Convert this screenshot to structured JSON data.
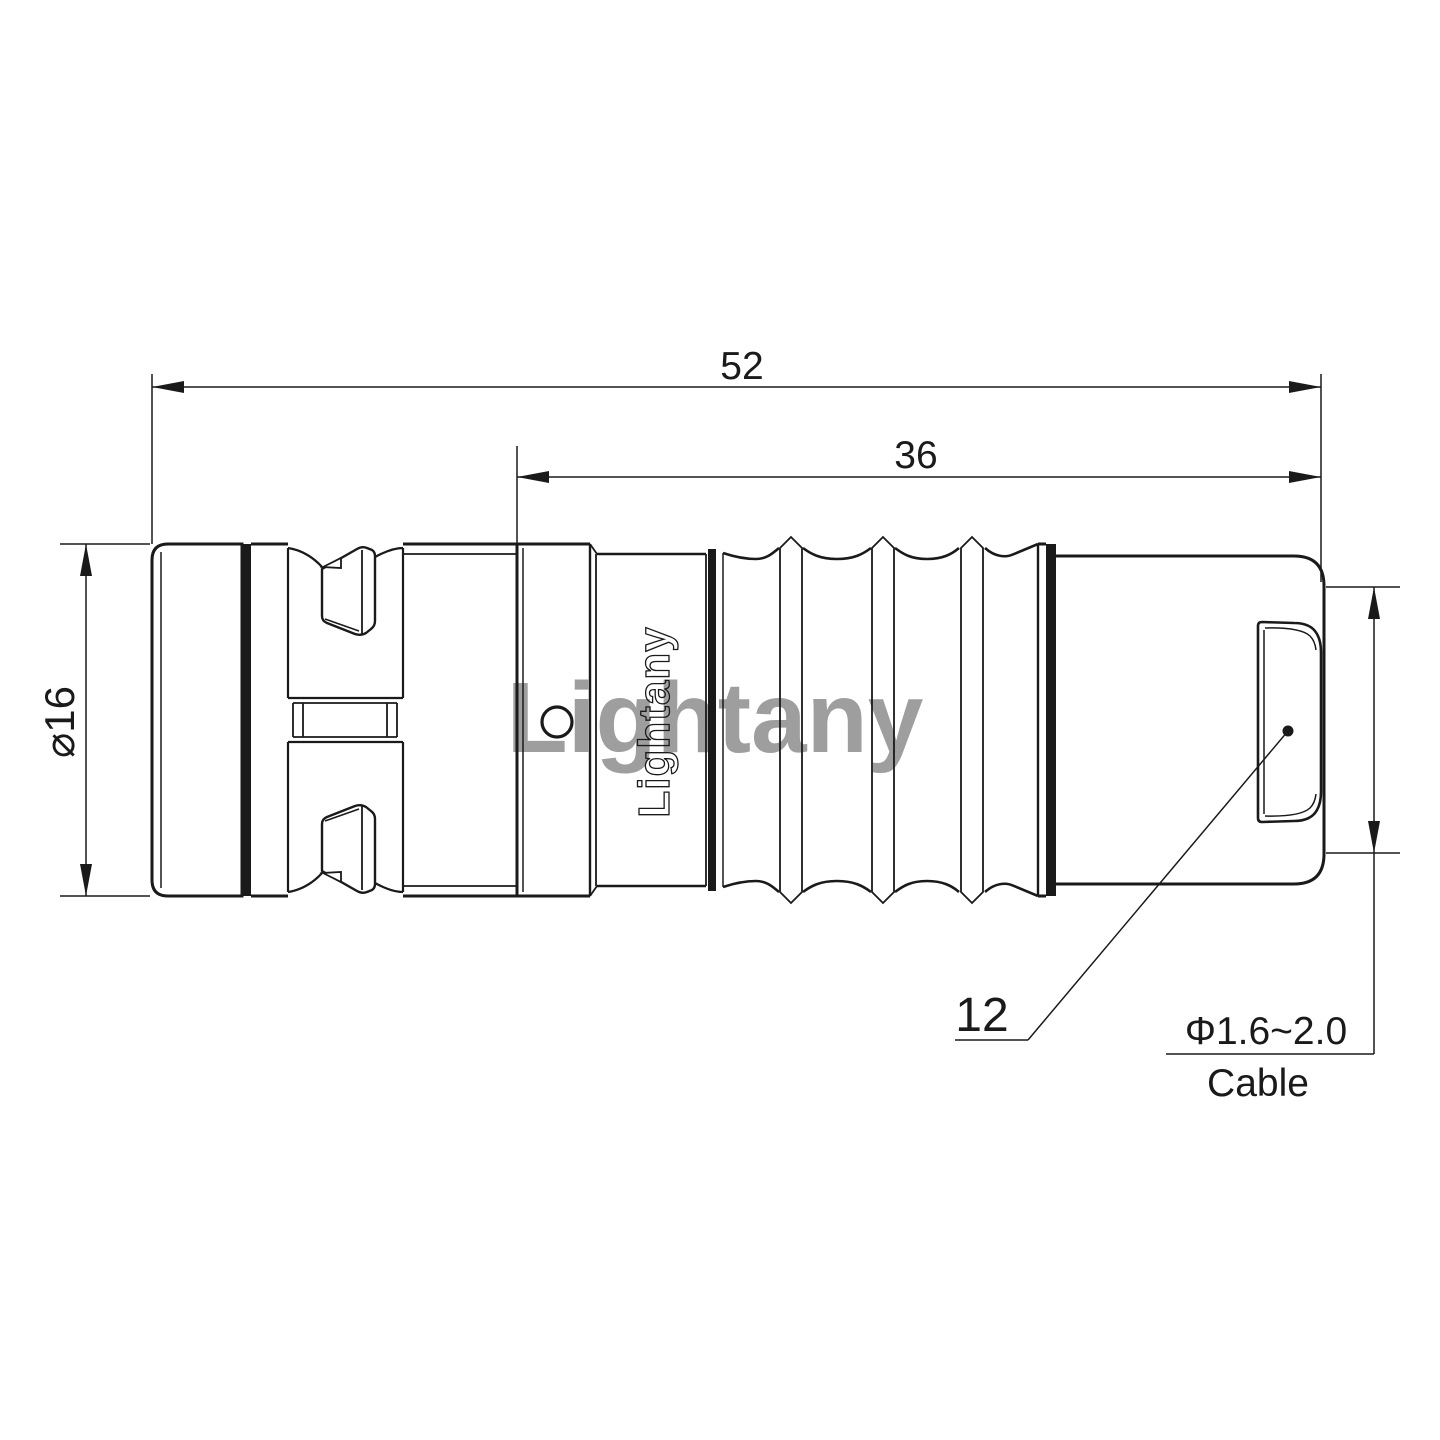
{
  "drawing": {
    "title_hint": "connector technical drawing",
    "watermark": {
      "text": "Lightany",
      "color": "#d97b7b"
    },
    "logo": {
      "text": "Lightany"
    },
    "dimensions": {
      "overall_length": "52",
      "grip_length": "36",
      "front_diameter": "⌀16",
      "rear_diameter": "12",
      "cable_range": "Φ1.6~2.0",
      "cable_word": "Cable"
    },
    "colors": {
      "line": "#1a1a1a",
      "background": "#ffffff",
      "watermark": "#d97b7b"
    }
  }
}
